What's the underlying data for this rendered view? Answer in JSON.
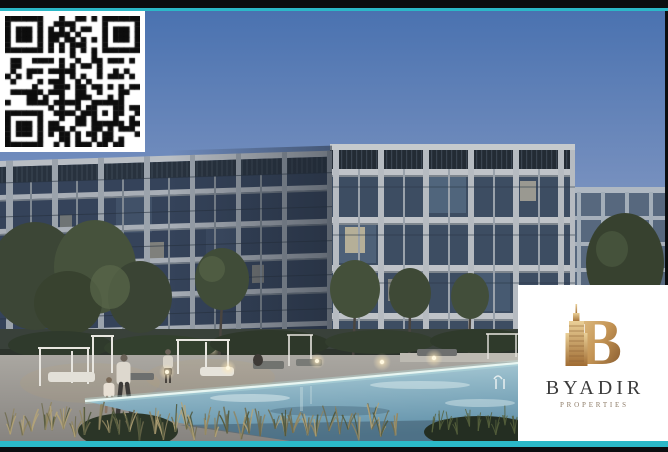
{
  "frame": {
    "bar_color": "#0b0d0f",
    "accent_color": "#2bb9c8"
  },
  "qr": {
    "grid": 25,
    "dark": "#0d0d0d",
    "light": "#ffffff",
    "seed": 987654
  },
  "logo_card": {
    "brand": "BYADIR",
    "tagline": "PROPERTIES",
    "bg": "#ffffff",
    "brand_color": "#3b3b3b",
    "tagline_color": "#8d7b67",
    "gold_light": "#e6c88f",
    "gold_mid": "#c49454",
    "gold_dark": "#7a4f27"
  },
  "scene": {
    "description": "Dusk architectural rendering of a modern L-shaped apartment complex with concrete grid facades, glass balconies, landscaped courtyard trees, white pergola cabanas, lounge chairs, glowing bollard lights, people walking on a stone deck, ornamental grasses and a large turquoise swimming pool",
    "sky_top": "#4a72b0",
    "sky_mid": "#7b93c0",
    "sky_horizon": "#a9bcd4",
    "concrete_light": "#c0c4c9",
    "concrete_shadow": "#9aa1a9",
    "glass_dark": "#3d4d62",
    "glass_shadow_wing": "#35435a",
    "tree_green": "#3c4636",
    "hedge": "#39413a",
    "deck": "#a29f9a",
    "pool_far": "#b7d3dc",
    "pool_near": "#5f8fa8",
    "pool_edge_glow": "#e8f6f2",
    "light_warm": "#ffe9b8",
    "grass_wheat": "#b5a478"
  }
}
